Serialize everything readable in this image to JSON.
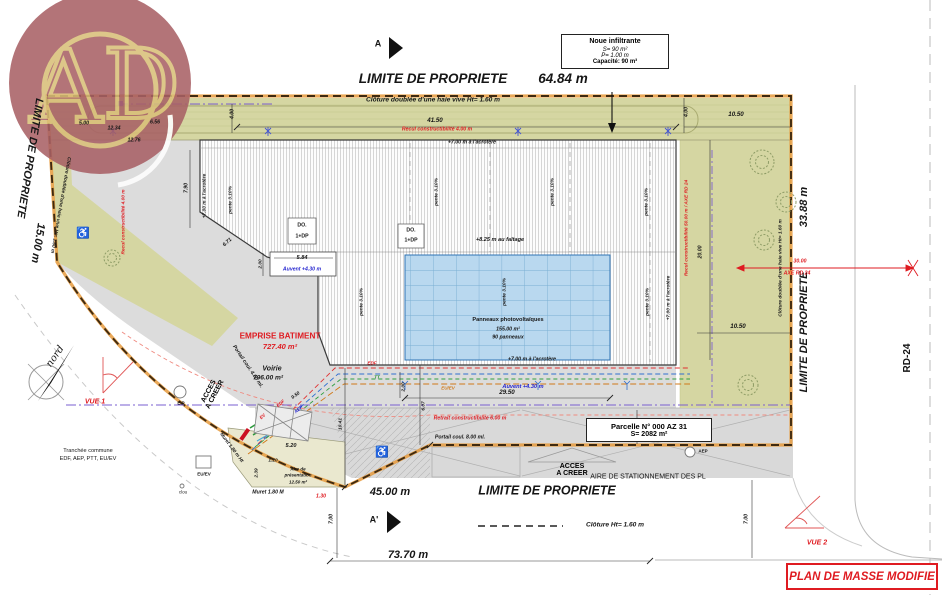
{
  "logo": {
    "monogram": "AD"
  },
  "sections": {
    "a": "A",
    "a_prime": "A'"
  },
  "boundaries": {
    "top_label": "LIMITE DE PROPRIETE",
    "top_length": "64.84 m",
    "left_label": "LIMITE DE PROPRIETE",
    "left_length": "15.00 m",
    "right_label": "LIMITE DE PROPRIETE",
    "right_length": "33.88 m",
    "bottom_label": "LIMITE DE PROPRIETE",
    "bottom_length_gate": "45.00 m",
    "bottom_length_total": "73.70 m",
    "road": "RD-24"
  },
  "fences": {
    "top": "Clôture doublée d'une haie vive Ht= 1.60 m",
    "left": "Clôture doublée d'une haie vive Ht= 1.60 m",
    "right": "Clôture doublée d'une haie vive Ht= 1.60 m",
    "legend": "Clôture Ht= 1.60 m"
  },
  "noue_box": {
    "title": "Noue infiltrante",
    "surface": "S= 90 m²",
    "depth": "P= 1.00 m",
    "capacity": "Capacité: 90 m³"
  },
  "parcel_box": {
    "line1": "Parcelle N° 000 AZ 31",
    "line2": "S= 2082 m²"
  },
  "setbacks": {
    "top": "Recul constructibilité 4.00 m",
    "left": "Recul constructibilité 4.00 m",
    "right": "Recul constructibilité 50.00 m / AXE RD 24",
    "bottom": "Retrait constructibilité 6.00 m",
    "axis_dim": "30.00",
    "axis_label": "AXE RD 24"
  },
  "building": {
    "emprise_title": "EMPRISE BATIMENT",
    "emprise_area": "727.40 m²",
    "faitage": "+8.25 m au faîtage",
    "acrotere": "+7.00 m à l'acrotère",
    "pente": "pente 3.10%",
    "do": "DO.",
    "dp": "1+DP",
    "auvent": "Auvent +4.30 m"
  },
  "panels": {
    "line1": "Panneaux photovoltaïques",
    "line2": "155.00 m²",
    "line3": "90 panneaux"
  },
  "areas": {
    "voirie_label": "Voirie",
    "voirie_area": "796.00 m²",
    "parking": "AIRE DE STATIONNEMENT DES PL",
    "aire_line1": "Aire de",
    "aire_line2": "présentation",
    "aire_line3": "12.50 m²"
  },
  "access": {
    "acces_line1": "ACCES",
    "acces_line2": "A CREER"
  },
  "gates": {
    "left": "Portail coul. 4.00 ml.",
    "bottom": "Portail coul. 8.00 ml."
  },
  "walls": {
    "diag": "Muret 1.80 m Ht",
    "bottom": "Muret 1.80 M"
  },
  "utilities": {
    "trench_line1": "Tranchée commune",
    "trench_line2": "EDF, AEP, PTT, EU/EV",
    "ep": "E.P",
    "euev_box": "EU/EV",
    "clou": "clou",
    "edf": "EDF",
    "tt": "TT",
    "euev": "EU/EV",
    "aep": "AEP",
    "ev": "EV",
    "aep_parking": "AEP"
  },
  "views": {
    "vue1": "VUE 1",
    "vue2": "VUE 2"
  },
  "compass": {
    "label": "nord"
  },
  "title_block": {
    "title": "PLAN DE MASSE MODIFIE"
  },
  "dims": {
    "d4150": "41.50",
    "d400a": "4.00",
    "d400b": "4.00",
    "d1050a": "10.50",
    "d1050b": "10.50",
    "d500": "5.00",
    "d1234": "12.34",
    "d656": "6.56",
    "d1276": "12.76",
    "d790": "7.90",
    "d671": "6.71",
    "d584": "5.84",
    "d200a": "2.00",
    "d200b": "2.00",
    "d950": "9.50",
    "d520": "5.20",
    "d120": "1.20",
    "d239": "2.39",
    "d1041": "10.41",
    "d607": "6.07",
    "d2950": "29.50",
    "d1000": "10.00",
    "d2000": "20.00",
    "d700a": "7.00",
    "d700b": "7.00",
    "d130": "1.30"
  }
}
